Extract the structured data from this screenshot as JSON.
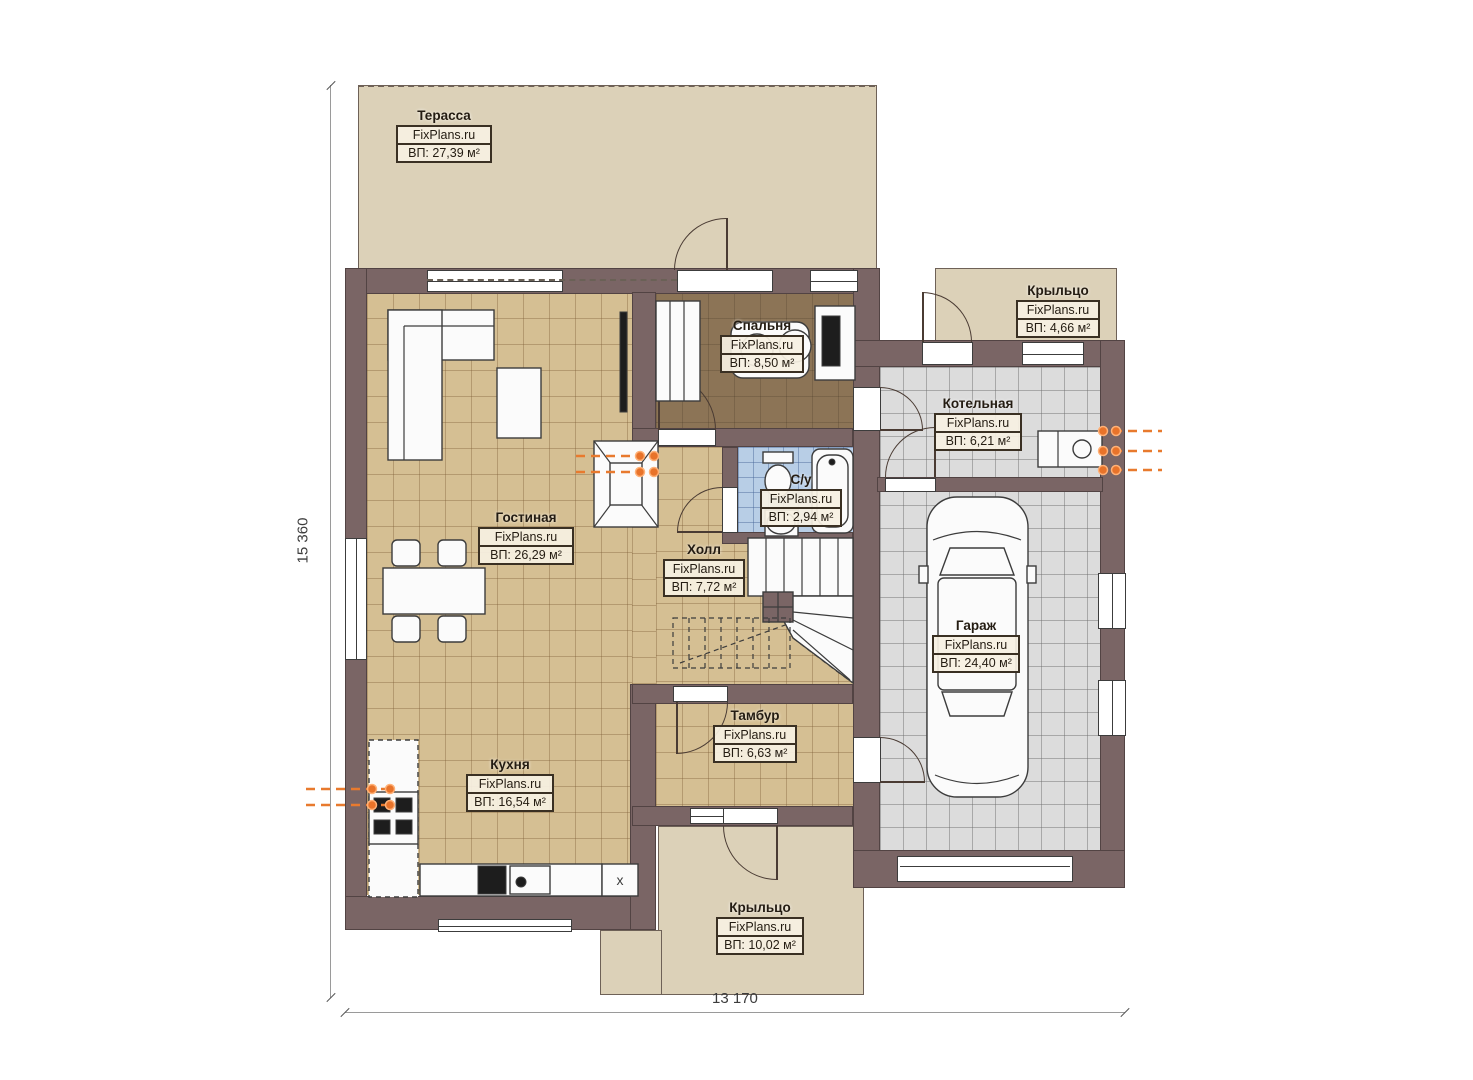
{
  "brand": "FixPlans.ru",
  "rooms": [
    {
      "id": "terrace",
      "name": "Терасса",
      "brand": "FixPlans.ru",
      "area": "ВП: 27,39 м²"
    },
    {
      "id": "porch-top",
      "name": "Крыльцо",
      "brand": "FixPlans.ru",
      "area": "ВП: 4,66 м²"
    },
    {
      "id": "bedroom",
      "name": "Спальня",
      "brand": "FixPlans.ru",
      "area": "ВП: 8,50 м²"
    },
    {
      "id": "boiler-room",
      "name": "Котельная",
      "brand": "FixPlans.ru",
      "area": "ВП: 6,21 м²"
    },
    {
      "id": "bathroom",
      "name": "С/у",
      "brand": "FixPlans.ru",
      "area": "ВП: 2,94 м²"
    },
    {
      "id": "living-room",
      "name": "Гостиная",
      "brand": "FixPlans.ru",
      "area": "ВП: 26,29 м²"
    },
    {
      "id": "hall",
      "name": "Холл",
      "brand": "FixPlans.ru",
      "area": "ВП: 7,72 м²"
    },
    {
      "id": "garage",
      "name": "Гараж",
      "brand": "FixPlans.ru",
      "area": "ВП: 24,40 м²"
    },
    {
      "id": "vestibule",
      "name": "Тамбур",
      "brand": "FixPlans.ru",
      "area": "ВП: 6,63 м²"
    },
    {
      "id": "kitchen",
      "name": "Кухня",
      "brand": "FixPlans.ru",
      "area": "ВП: 16,54 м²"
    },
    {
      "id": "porch-bottom",
      "name": "Крыльцо",
      "brand": "FixPlans.ru",
      "area": "ВП: 10,02 м²"
    }
  ],
  "dimensions": {
    "height": "15 360",
    "width": "13 170"
  },
  "marks": {
    "kitchen_unit": "x"
  },
  "colors": {
    "wall": "#7a6565",
    "floor_tan": "#d5bf93",
    "floor_garage": "#dcdcdc",
    "floor_bath": "#b8cee6",
    "floor_bedroom": "#8c7456",
    "terrace": "#dcd1b8",
    "vent_arrow": "#e87a2e"
  }
}
